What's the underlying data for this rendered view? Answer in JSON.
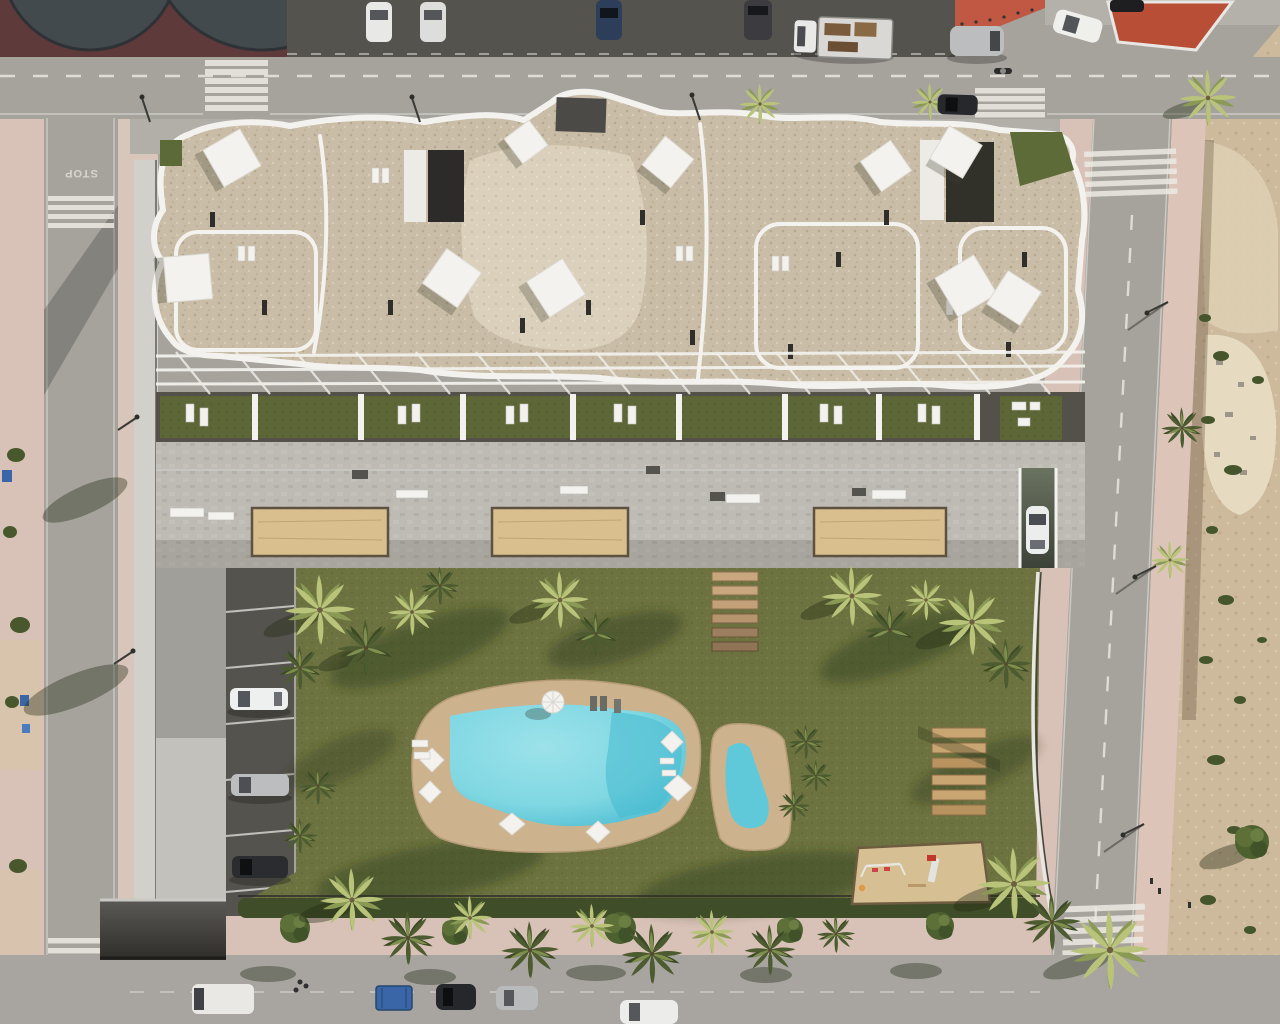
{
  "road_markings": {
    "stop": "STOP"
  },
  "palette": {
    "road": "#a6a39d",
    "sidewalk": "#d8c1b6",
    "plaza": "#5e3a3a",
    "plazaCircle": "#434a4e",
    "parkStrip": "#55534d",
    "redTile": "#c05844",
    "island": "#b94e36",
    "dirt": "#cdb99b",
    "dirtLight": "#decfb2",
    "rubble": "#e6dac0",
    "roofBeige": "#cabda7",
    "roofLight": "#dad0bb",
    "roofDark": "#2f2e2b",
    "parapet": "#f3f2ee",
    "lawn": "#5d6636",
    "grass": "#6d7340",
    "deck": "#bdbbb4",
    "planterSand": "#d9bf8e",
    "poolDeck": "#ccb28d",
    "poolWater": "#7fd7e2",
    "poolWaterDeep": "#46b9cf",
    "palmLight": "#b9c47a",
    "palmDark": "#4c5c30",
    "white": "#f3f2ee",
    "carDark": "#2a2c2f",
    "carSilver": "#bcbdbf",
    "dumpsterBlue": "#3a66a8",
    "woodLounger": "#c9a571",
    "hedge": "#3f4d28",
    "playSand": "#d6bf93",
    "marking": "#eceae4"
  },
  "inventory": {
    "pools": 2,
    "sand_planters": 3,
    "stepping_stones": 6,
    "wooden_sun_loungers": 6,
    "terrace_gardens": 8,
    "crosswalks": 5,
    "cars_parked_driveway": 3,
    "rooftop_sails": 10
  }
}
